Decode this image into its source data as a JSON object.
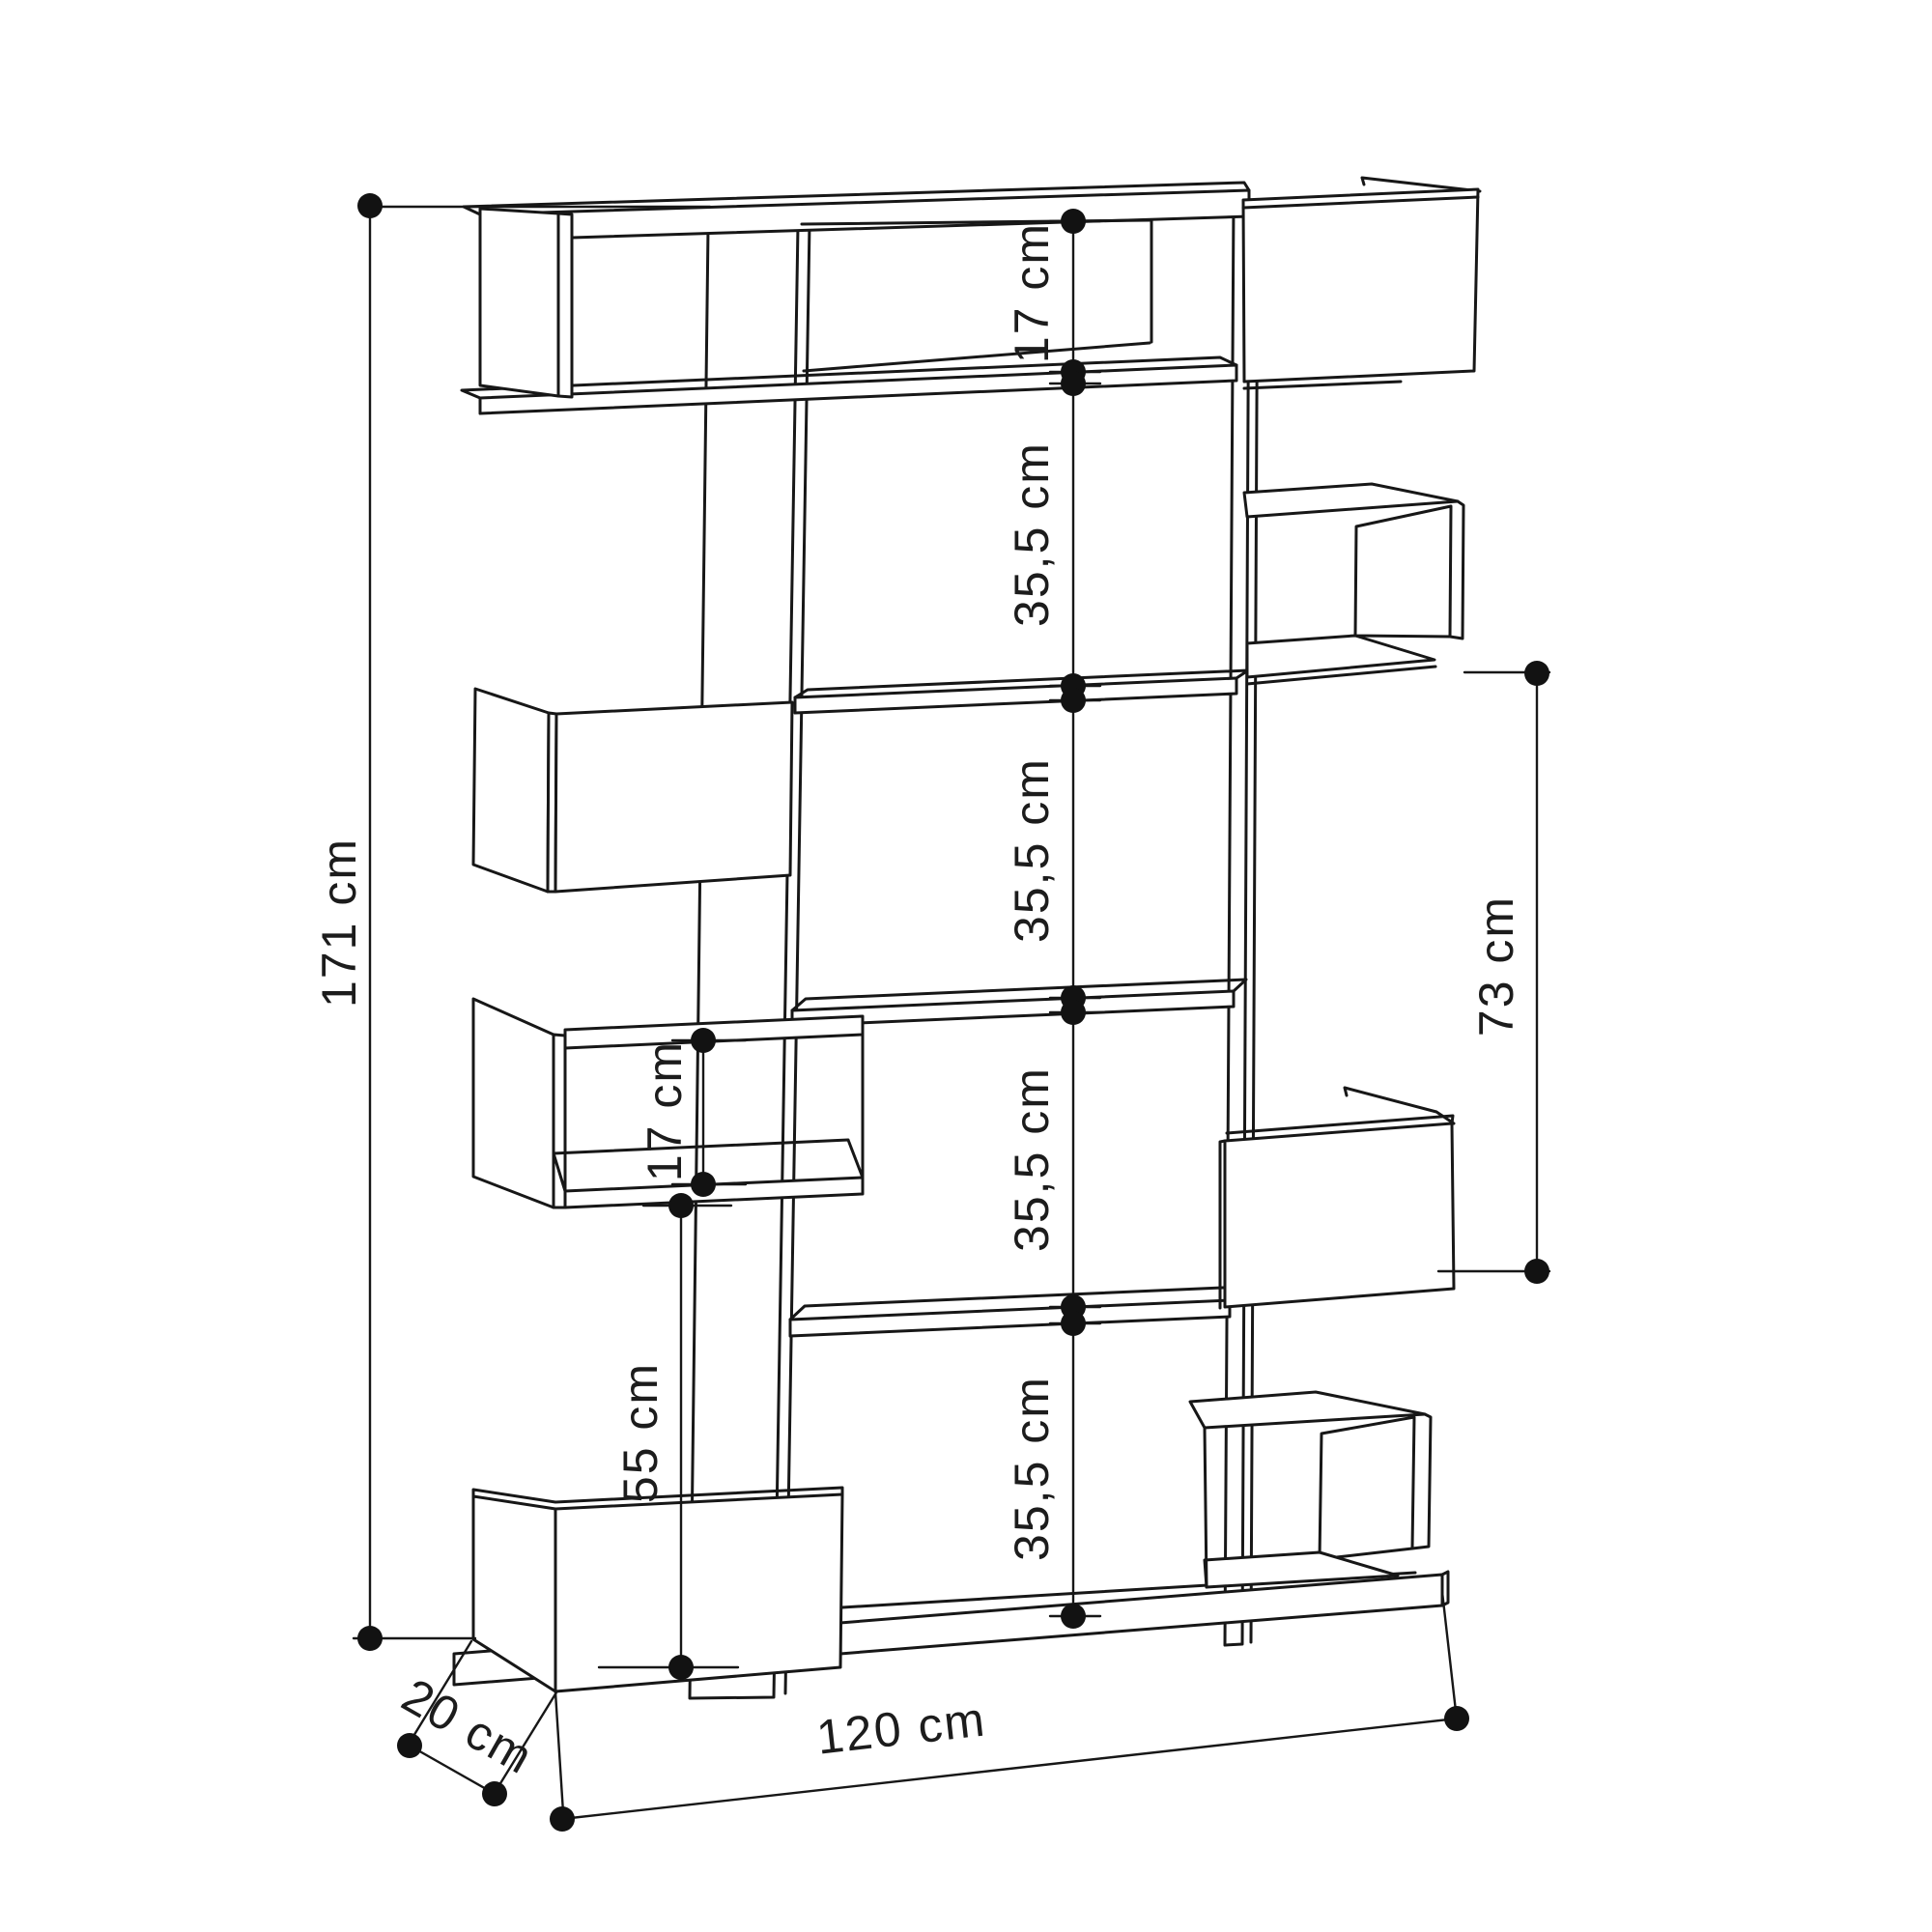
{
  "diagram": {
    "kind": "furniture-dimension-drawing",
    "subject": "staggered open bookshelf, perspective line drawing",
    "colors": {
      "line": "#171717",
      "background": "#ffffff"
    },
    "labels": {
      "total_height": "171 cm",
      "top_cell_height": "17 cm",
      "shelf_gap_1": "35,5 cm",
      "shelf_gap_2": "35,5 cm",
      "shelf_gap_3": "35,5 cm",
      "shelf_gap_4": "35,5 cm",
      "right_section_height": "73 cm",
      "left_cubby_height": "17 cm",
      "left_lower_height": "55 cm",
      "total_width": "120 cm",
      "total_depth": "20 cm"
    }
  }
}
